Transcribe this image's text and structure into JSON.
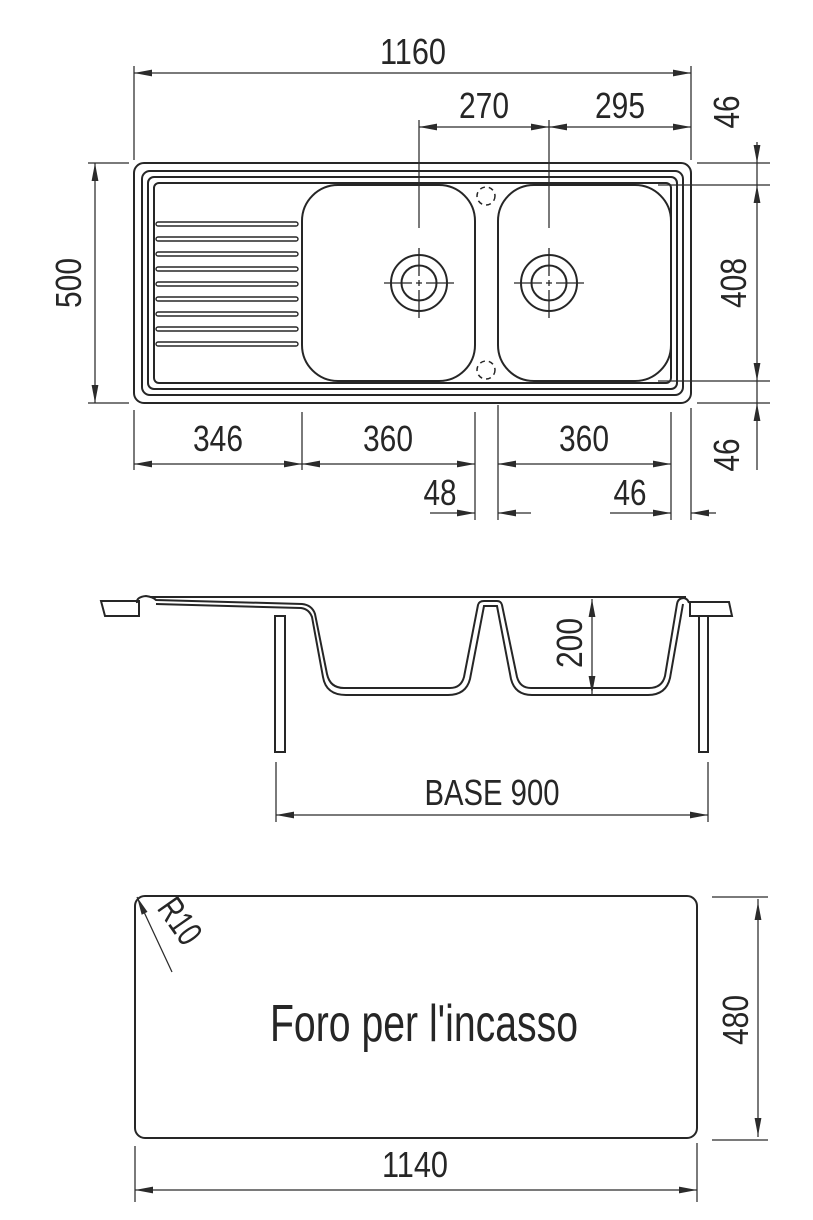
{
  "drawing": {
    "title": "Sink technical drawing",
    "colors": {
      "line": "#262626",
      "dimension": "#2b2b2b",
      "background": "#ffffff"
    },
    "plan": {
      "w_total": "1160",
      "d_drains": "270",
      "d_drain_edge": "295",
      "h_total": "500",
      "m_top": "46",
      "h_bowl": "408",
      "m_bottom": "46",
      "w_drainboard": "346",
      "w_bowl1": "360",
      "w_bowl2": "360",
      "w_gap": "48",
      "m_right": "46"
    },
    "section": {
      "depth": "200",
      "base": "BASE 900"
    },
    "cutout": {
      "label": "Foro per l'incasso",
      "radius": "R10",
      "h": "480",
      "w": "1140"
    }
  }
}
